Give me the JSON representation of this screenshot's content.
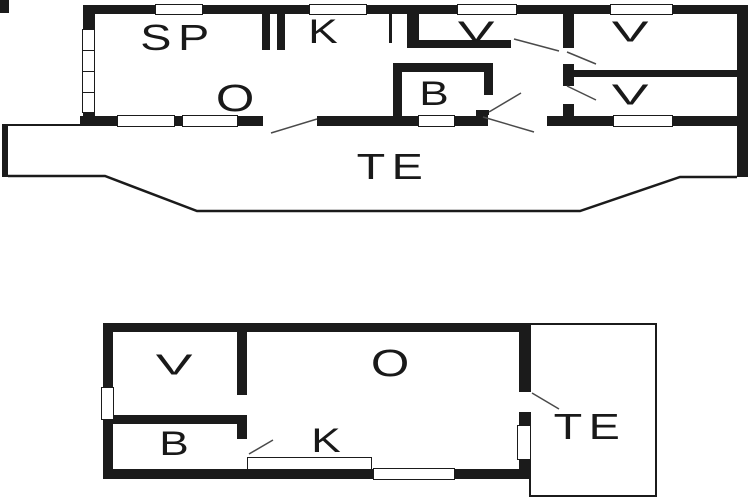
{
  "figure": {
    "type": "floor-plan",
    "colors": {
      "wall": "#1b1b1b",
      "thin_line": "#4a4a4a",
      "background": "#ffffff"
    },
    "floors": [
      {
        "name": "upper floor plan",
        "rooms": [
          {
            "label": "SP"
          },
          {
            "label": "K"
          },
          {
            "label": "O"
          },
          {
            "label": "B"
          },
          {
            "label": "V"
          },
          {
            "label": "V"
          },
          {
            "label": "V"
          },
          {
            "label": "TE"
          }
        ]
      },
      {
        "name": "lower floor plan",
        "rooms": [
          {
            "label": "V"
          },
          {
            "label": "O"
          },
          {
            "label": "B"
          },
          {
            "label": "K"
          },
          {
            "label": "TE"
          }
        ]
      }
    ]
  }
}
